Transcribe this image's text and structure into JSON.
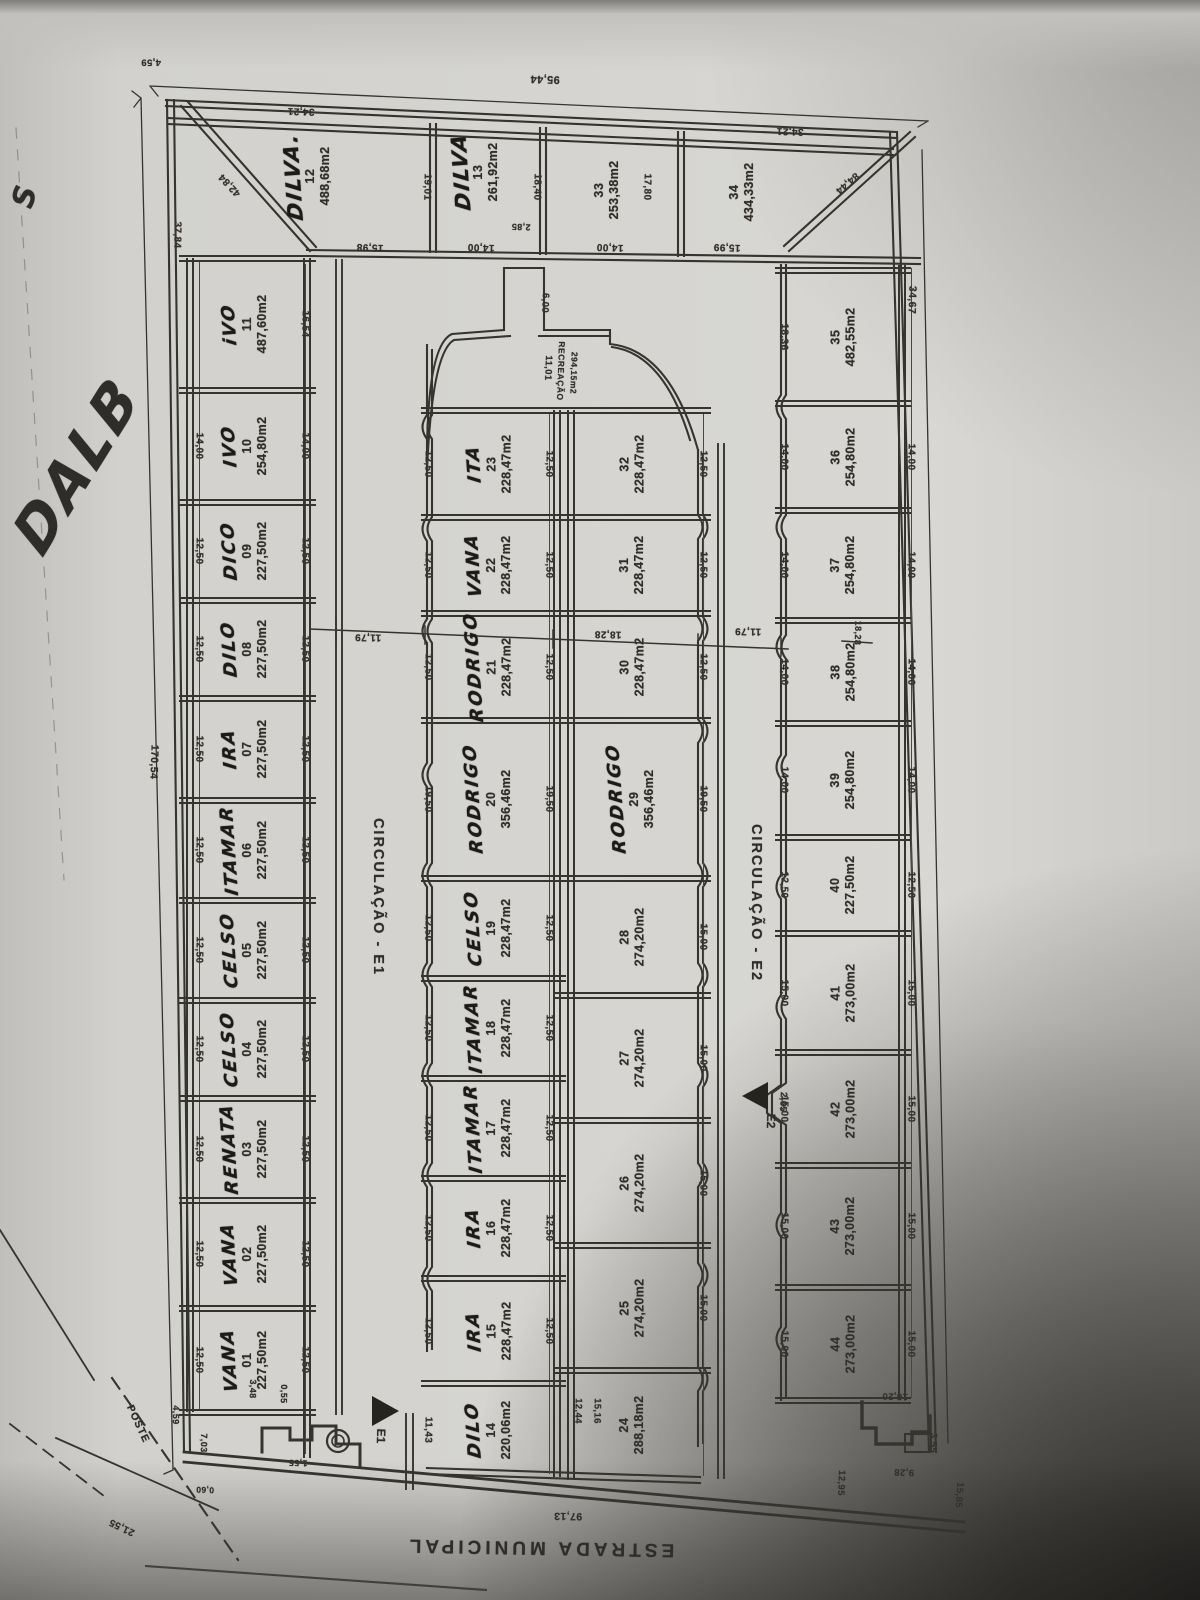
{
  "annotations": {
    "corner_letter": "S",
    "side_handwriting": "DALB"
  },
  "streets": {
    "estrada": "ESTRADA MUNICIPAL",
    "e1": "CIRCULAÇÃO - E1",
    "e2": "CIRCULAÇÃO - E2",
    "e1_marker": "E1",
    "e2_marker": "E2",
    "poste": "POSTE"
  },
  "recreation": {
    "label": "RECREAÇÃO",
    "area": "294,15m2"
  },
  "overall": {
    "top_width": "95,44",
    "left_length": "170,54",
    "road_frontage": "97,13",
    "right_length": "34,67"
  },
  "corner_lots": [
    {
      "n": "12",
      "name": "DILVA.",
      "area": "488,68m2",
      "c": [
        308,
        176
      ]
    },
    {
      "n": "13",
      "name": "DILVA",
      "area": "261,92m2",
      "c": [
        476,
        172
      ]
    },
    {
      "n": "33",
      "name": "",
      "area": "253,38m2",
      "c": [
        607,
        190
      ]
    },
    {
      "n": "34",
      "name": "",
      "area": "434,33m2",
      "c": [
        742,
        192
      ]
    }
  ],
  "strips": [
    {
      "id": "A",
      "x0": 192,
      "x1": 303,
      "cx": 245,
      "dimL": 199,
      "dimR": 305,
      "capTop": true,
      "capBot": true,
      "vlines": [
        [
          186,
          258,
          1412,
          2
        ],
        [
          192,
          258,
          1412,
          2
        ],
        [
          303,
          258,
          1458,
          2
        ],
        [
          309,
          258,
          1458,
          2
        ],
        [
          199,
          262,
          1410,
          1
        ],
        [
          305,
          264,
          1454,
          1
        ]
      ],
      "lots": [
        {
          "n": "11",
          "name": "iVO",
          "area": "487,60m2",
          "y": [
            258,
            390
          ],
          "dr": "16,54"
        },
        {
          "n": "10",
          "name": "IVO",
          "area": "254,80m2",
          "y": [
            390,
            502
          ],
          "dl": "14,00",
          "dr": "14,00"
        },
        {
          "n": "09",
          "name": "DICO",
          "area": "227,50m2",
          "y": [
            502,
            600
          ],
          "dl": "12,50",
          "dr": "12,50"
        },
        {
          "n": "08",
          "name": "DILO",
          "area": "227,50m2",
          "y": [
            600,
            698
          ],
          "dl": "12,50",
          "dr": "12,50"
        },
        {
          "n": "07",
          "name": "IRA",
          "area": "227,50m2",
          "y": [
            698,
            800
          ],
          "dl": "12,50",
          "dr": "12,50"
        },
        {
          "n": "06",
          "name": "ITAMAR",
          "area": "227,50m2",
          "y": [
            800,
            900
          ],
          "dl": "12,50",
          "dr": "12,50"
        },
        {
          "n": "05",
          "name": "CELSO",
          "area": "227,50m2",
          "y": [
            900,
            1000
          ],
          "dl": "12,50",
          "dr": "12,50"
        },
        {
          "n": "04",
          "name": "CELSO",
          "area": "227,50m2",
          "y": [
            1000,
            1098
          ],
          "dl": "12,50",
          "dr": "12,50"
        },
        {
          "n": "03",
          "name": "RENATA",
          "area": "227,50m2",
          "y": [
            1098,
            1200
          ],
          "dl": "12,50",
          "dr": "12,50"
        },
        {
          "n": "02",
          "name": "VANA",
          "area": "227,50m2",
          "y": [
            1200,
            1308
          ],
          "dl": "12,50",
          "dr": "12,50"
        },
        {
          "n": "01",
          "name": "VANA",
          "area": "227,50m2",
          "y": [
            1308,
            1412
          ],
          "dl": "12,50",
          "dr": "12,50"
        }
      ]
    },
    {
      "id": "B",
      "x0": 434,
      "x1": 553,
      "cx": 489,
      "dimL": 428,
      "dimR": 549,
      "capTop": true,
      "capBot": false,
      "vlines": [
        [
          553,
          410,
          1477,
          2
        ],
        [
          559,
          410,
          1477,
          2
        ],
        [
          549,
          414,
          1474,
          1
        ]
      ],
      "lots": [
        {
          "n": "23",
          "name": "ITA",
          "area": "228,47m2",
          "y": [
            410,
            517
          ],
          "dl": "12,50",
          "dr": "12,50"
        },
        {
          "n": "22",
          "name": "VANA",
          "area": "228,47m2",
          "y": [
            517,
            613
          ],
          "dl": "12,50",
          "dr": "12,50"
        },
        {
          "n": "21",
          "name": "RODRIGO",
          "area": "228,47m2",
          "y": [
            613,
            720
          ],
          "dl": "12,50",
          "dr": "12,50"
        },
        {
          "n": "20",
          "name": "RODRIGO",
          "area": "356,46m2",
          "y": [
            720,
            878
          ],
          "dl": "19,50",
          "dr": "19,50"
        },
        {
          "n": "19",
          "name": "CELSO",
          "area": "228,47m2",
          "y": [
            878,
            978
          ],
          "dl": "12,50",
          "dr": "12,50"
        },
        {
          "n": "18",
          "name": "ITAMAR",
          "area": "228,47m2",
          "y": [
            978,
            1078
          ],
          "dl": "12,50",
          "dr": "12,50"
        },
        {
          "n": "17",
          "name": "ITAMAR",
          "area": "228,47m2",
          "y": [
            1078,
            1178
          ],
          "dl": "12,50",
          "dr": "12,50"
        },
        {
          "n": "16",
          "name": "IRA",
          "area": "228,47m2",
          "y": [
            1178,
            1278
          ],
          "dl": "12,50",
          "dr": "12,50"
        },
        {
          "n": "15",
          "name": "IRA",
          "area": "228,47m2",
          "y": [
            1278,
            1383
          ],
          "dl": "12,50",
          "dr": "12,50"
        },
        {
          "n": "14",
          "name": "DILO",
          "area": "220,06m2",
          "y": [
            1383,
            1477
          ],
          "dl": "11,43"
        }
      ]
    },
    {
      "id": "C",
      "x0": 567,
      "x1": 698,
      "cx": 632,
      "dimR": 703,
      "capTop": true,
      "capBot": false,
      "vlines": [
        [
          567,
          410,
          1480,
          2
        ],
        [
          573,
          410,
          1480,
          2
        ],
        [
          703,
          414,
          1476,
          1
        ]
      ],
      "lots": [
        {
          "n": "32",
          "name": "",
          "area": "228,47m2",
          "y": [
            410,
            517
          ],
          "dr": "12,50"
        },
        {
          "n": "31",
          "name": "",
          "area": "228,47m2",
          "y": [
            517,
            613
          ],
          "dr": "12,50"
        },
        {
          "n": "30",
          "name": "",
          "area": "228,47m2",
          "y": [
            613,
            720
          ],
          "dr": "12,50"
        },
        {
          "n": "29",
          "name": "RODRIGO",
          "area": "356,46m2",
          "y": [
            720,
            878
          ],
          "dr": "19,50"
        },
        {
          "n": "28",
          "name": "",
          "area": "274,20m2",
          "y": [
            878,
            995
          ],
          "dr": "15,00"
        },
        {
          "n": "27",
          "name": "",
          "area": "274,20m2",
          "y": [
            995,
            1120
          ],
          "dr": "15,00"
        },
        {
          "n": "26",
          "name": "",
          "area": "274,20m2",
          "y": [
            1120,
            1245
          ],
          "dr": "15,00"
        },
        {
          "n": "25",
          "name": "",
          "area": "274,20m2",
          "y": [
            1245,
            1370
          ],
          "dr": "15,00"
        },
        {
          "n": "24",
          "name": "",
          "area": "288,18m2",
          "y": [
            1370,
            1480
          ]
        }
      ]
    },
    {
      "id": "D",
      "x0": 788,
      "x1": 898,
      "cx": 843,
      "dimL": 784,
      "dimR": 911,
      "capTop": true,
      "capBot": true,
      "vlines": [
        [
          898,
          265,
          1400,
          2
        ],
        [
          904,
          265,
          1400,
          2
        ],
        [
          911,
          268,
          1398,
          1
        ]
      ],
      "lots": [
        {
          "n": "35",
          "name": "",
          "area": "482,55m2",
          "y": [
            270,
            403
          ],
          "dl": "18,36"
        },
        {
          "n": "36",
          "name": "",
          "area": "254,80m2",
          "y": [
            403,
            510
          ],
          "dl": "14,00",
          "dr": "14,00"
        },
        {
          "n": "37",
          "name": "",
          "area": "254,80m2",
          "y": [
            510,
            620
          ],
          "dl": "14,00",
          "dr": "14,00"
        },
        {
          "n": "38",
          "name": "",
          "area": "254,80m2",
          "y": [
            620,
            723
          ],
          "dl": "14,00",
          "dr": "14,00"
        },
        {
          "n": "39",
          "name": "",
          "area": "254,80m2",
          "y": [
            723,
            837
          ],
          "dl": "14,00",
          "dr": "14,00"
        },
        {
          "n": "40",
          "name": "",
          "area": "227,50m2",
          "y": [
            837,
            933
          ],
          "dl": "12,50",
          "dr": "12,50"
        },
        {
          "n": "41",
          "name": "",
          "area": "273,00m2",
          "y": [
            933,
            1052
          ],
          "dl": "15,00",
          "dr": "15,00"
        },
        {
          "n": "42",
          "name": "",
          "area": "273,00m2",
          "y": [
            1052,
            1165
          ],
          "dl": "15,00",
          "dr": "15,00"
        },
        {
          "n": "43",
          "name": "",
          "area": "273,00m2",
          "y": [
            1165,
            1287
          ],
          "dl": "15,00",
          "dr": "15,00"
        },
        {
          "n": "44",
          "name": "",
          "area": "273,00m2",
          "y": [
            1287,
            1400
          ],
          "dl": "15,00",
          "dr": "15,00"
        }
      ]
    }
  ],
  "loose_dims": [
    [
      "95,44",
      545,
      79,
      182,
      11
    ],
    [
      "4,59",
      151,
      62,
      180,
      9.5
    ],
    [
      "34,21",
      301,
      111,
      182,
      10
    ],
    [
      "34,21",
      790,
      131,
      182,
      10
    ],
    [
      "42,84",
      230,
      185,
      227,
      10
    ],
    [
      "84,44",
      847,
      183,
      139,
      10
    ],
    [
      "37,84",
      177,
      235,
      91,
      10
    ],
    [
      "19,01",
      427,
      187,
      91,
      10
    ],
    [
      "18,40",
      537,
      187,
      91,
      10
    ],
    [
      "17,80",
      647,
      187,
      91,
      10
    ],
    [
      "15,98",
      370,
      247,
      182,
      10
    ],
    [
      "14,00",
      481,
      247,
      182,
      10
    ],
    [
      "2,85",
      521,
      227,
      182,
      9
    ],
    [
      "14,00",
      610,
      247,
      182,
      10
    ],
    [
      "15,99",
      727,
      247,
      182,
      10
    ],
    [
      "170,54",
      154,
      762,
      92,
      10.5
    ],
    [
      "34,67",
      912,
      300,
      92,
      10.5
    ],
    [
      "6,00",
      545,
      303,
      92,
      9.5
    ],
    [
      "11,01",
      548,
      368,
      92,
      9.5
    ],
    [
      "11,79",
      368,
      637,
      181,
      10
    ],
    [
      "18,28",
      608,
      634,
      181,
      10
    ],
    [
      "11,79",
      748,
      631,
      181,
      10
    ],
    [
      "18,28",
      858,
      633,
      92,
      9
    ],
    [
      "2,65",
      783,
      1102,
      92,
      9.5
    ],
    [
      "12,44",
      578,
      1411,
      91,
      9.5
    ],
    [
      "15,16",
      597,
      1411,
      91,
      9.5
    ],
    [
      "3,48",
      253,
      1389,
      91,
      9
    ],
    [
      "0,55",
      284,
      1394,
      91,
      9
    ],
    [
      "1,55",
      298,
      1463,
      182,
      9
    ],
    [
      "7,03",
      204,
      1443,
      91,
      9
    ],
    [
      "4,59",
      176,
      1415,
      91,
      9
    ],
    [
      "0,60",
      205,
      1490,
      182,
      8.5
    ],
    [
      "97,13",
      568,
      1516,
      181,
      10.5
    ],
    [
      "21,55",
      122,
      1527,
      206,
      10
    ],
    [
      "16,20",
      895,
      1396,
      182,
      9.5
    ],
    [
      "3,55",
      933,
      1443,
      92,
      9.5
    ],
    [
      "9,28",
      904,
      1472,
      182,
      9.5
    ],
    [
      "15,85",
      959,
      1495,
      94,
      9.5
    ],
    [
      "12,95",
      841,
      1483,
      92,
      9.5
    ]
  ]
}
